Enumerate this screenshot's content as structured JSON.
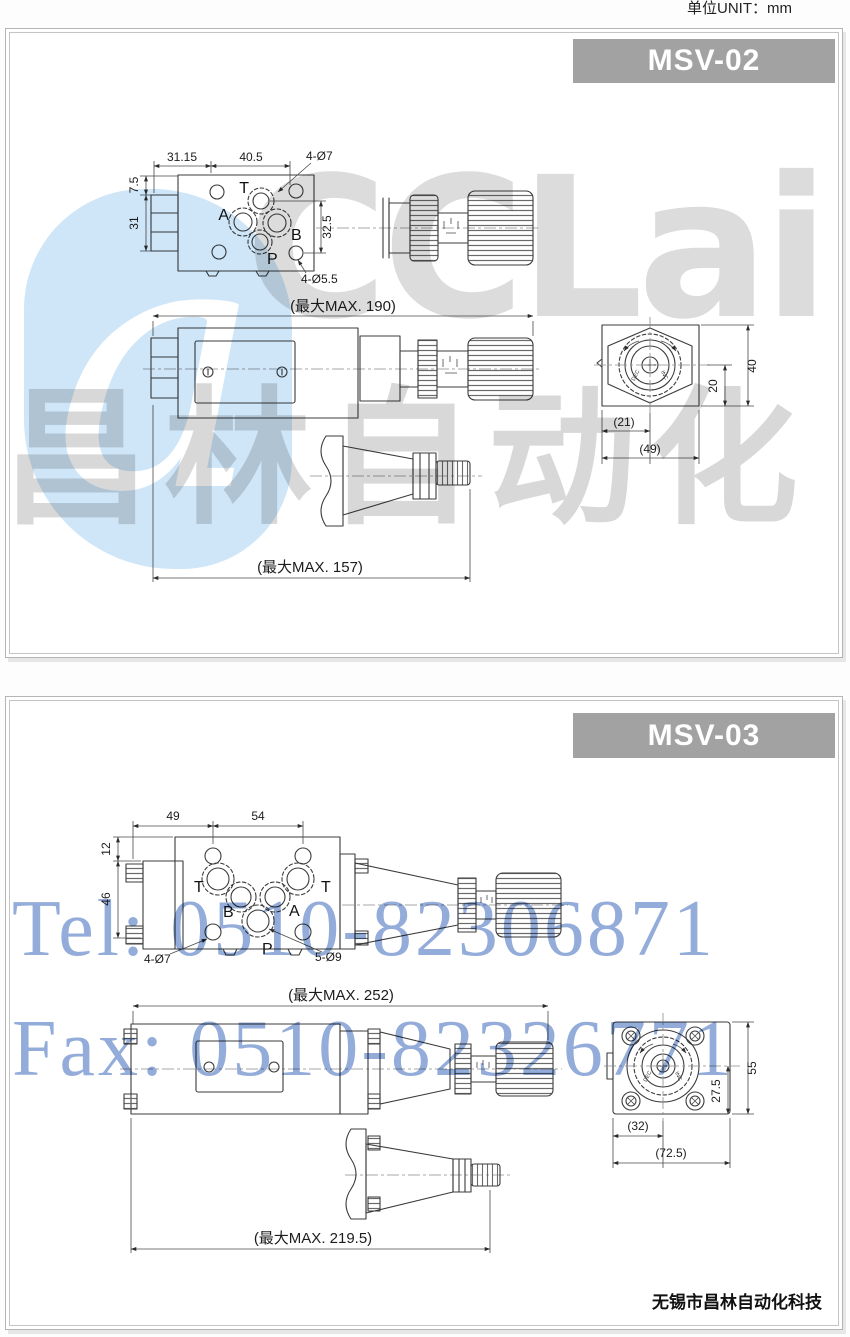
{
  "unit_label": "单位UNIT：mm",
  "colors": {
    "header_bg": "#a2a2a2",
    "header_text": "#ffffff",
    "drawing_line": "#3b3b3b",
    "watermark_gray": "#dcdcdc",
    "watermark_blue_bg": "#cfe6f8",
    "watermark_tel_blue": "#93acd9",
    "page_bg": "#ffffff"
  },
  "watermark": {
    "logo_a": "a",
    "logo_text": "CCLair",
    "logo_cn": "昌林自动化",
    "tel": "Tel: 0510-82306871",
    "fax": "Fax: 0510-82326771"
  },
  "msv02": {
    "model": "MSV-02",
    "plan": {
      "dim_left": "31.15",
      "dim_right": "40.5",
      "holes_top": "4-Ø7",
      "dim_offset": "7.5",
      "dim_height": "31",
      "dim_ports": "32.5",
      "holes_bottom": "4-Ø5.5",
      "port_t": "T",
      "port_a": "A",
      "port_b": "B",
      "port_p": "P"
    },
    "side": {
      "max_len": "(最大MAX. 190)"
    },
    "end": {
      "dim_20": "20",
      "dim_40": "40",
      "dim_21": "(21)",
      "dim_49": "(49)",
      "knob_dec": "DEC",
      "knob_inc": "INC"
    },
    "screw": {
      "max_len": "(最大MAX. 157)"
    }
  },
  "msv03": {
    "model": "MSV-03",
    "plan": {
      "dim_left": "49",
      "dim_right": "54",
      "dim_top": "12",
      "dim_height": "46",
      "holes_corner": "4-Ø7",
      "holes_ports": "5-Ø9",
      "port_t1": "T",
      "port_b": "B",
      "port_a": "A",
      "port_t2": "T",
      "port_p": "P"
    },
    "side": {
      "max_len": "(最大MAX. 252)"
    },
    "end": {
      "dim_275": "27.5",
      "dim_55": "55",
      "dim_32": "(32)",
      "dim_725": "(72.5)",
      "knob_dec": "DEC",
      "knob_inc": "INC"
    },
    "screw": {
      "max_len": "(最大MAX. 219.5)"
    }
  },
  "footer": {
    "company": "无锡市昌林自动化科技"
  }
}
